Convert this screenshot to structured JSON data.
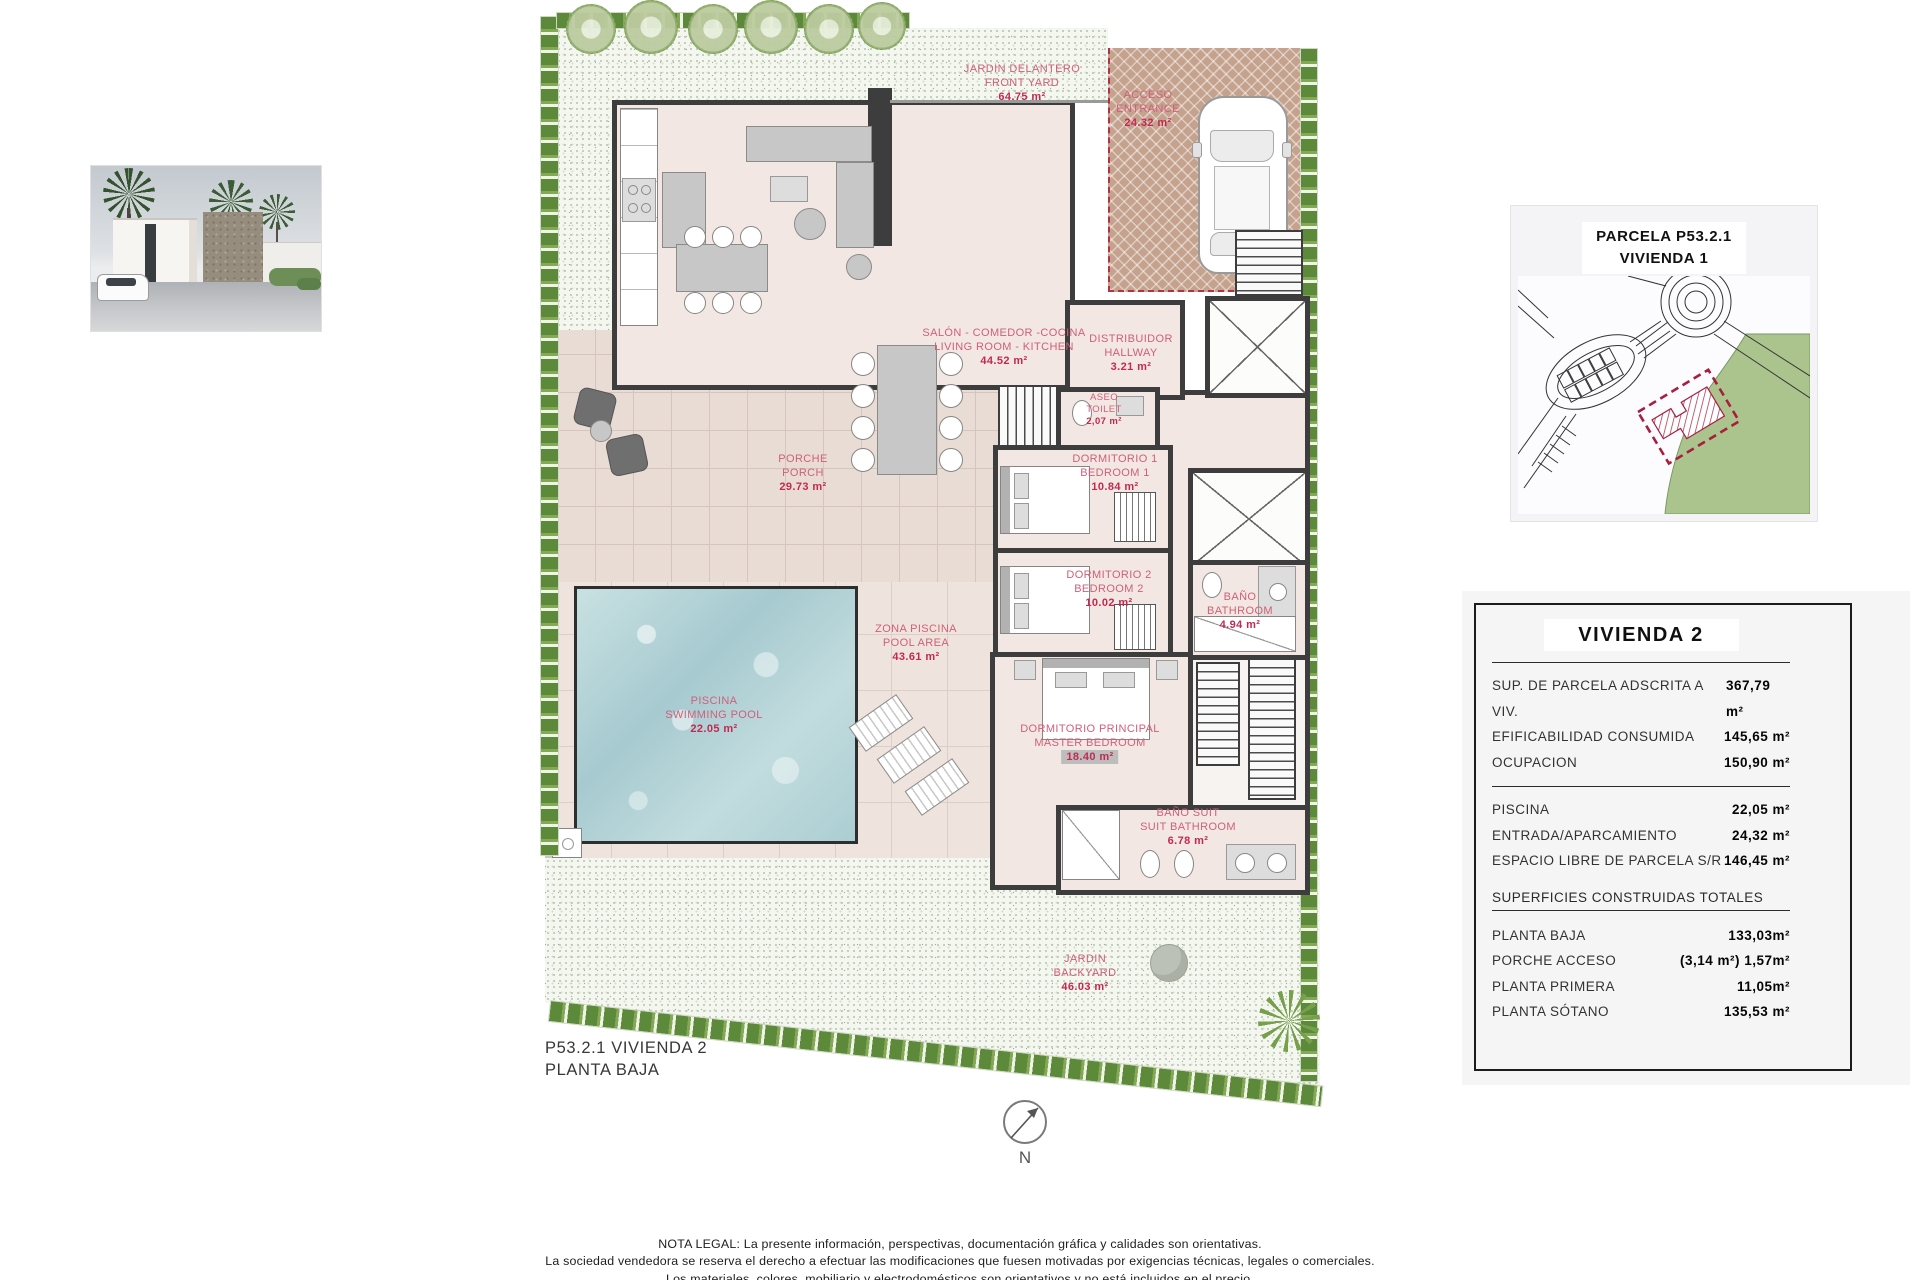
{
  "photo": {
    "name": "villa-exterior-render"
  },
  "site_map": {
    "title_line1": "PARCELA P53.2.1",
    "title_line2": "VIVIENDA 1"
  },
  "plan": {
    "rooms": [
      {
        "id": "front-yard",
        "es": "JARDIN DELANTERO",
        "en": "FRONT YARD",
        "area": "64.75 m²"
      },
      {
        "id": "entrance",
        "es": "ACCESO",
        "en": "ENTRANCE",
        "area": "24.32 m²"
      },
      {
        "id": "living",
        "es": "SALÓN - COMEDOR -COCINA",
        "en": "LIVING ROOM - KITCHEN",
        "area": "44.52 m²"
      },
      {
        "id": "hallway",
        "es": "DISTRIBUIDOR",
        "en": "HALLWAY",
        "area": "3.21 m²"
      },
      {
        "id": "toilet",
        "es": "ASEO",
        "en": "TOILET",
        "area": "2,07 m²"
      },
      {
        "id": "bedroom1",
        "es": "DORMITORIO 1",
        "en": "BEDROOM 1",
        "area": "10.84 m²"
      },
      {
        "id": "bedroom2",
        "es": "DORMITORIO 2",
        "en": "BEDROOM 2",
        "area": "10.02 m²"
      },
      {
        "id": "bathroom",
        "es": "BAÑO",
        "en": "BATHROOM",
        "area": "4.94 m²"
      },
      {
        "id": "master-bedroom",
        "es": "DORMITORIO PRINCIPAL",
        "en": "MASTER BEDROOM",
        "area": "18.40 m²"
      },
      {
        "id": "suite-bathroom",
        "es": "BAÑO SUIT",
        "en": "SUIT BATHROOM",
        "area": "6.78 m²"
      },
      {
        "id": "porch",
        "es": "PORCHE",
        "en": "PORCH",
        "area": "29.73 m²"
      },
      {
        "id": "pool-area",
        "es": "ZONA PISCINA",
        "en": "POOL AREA",
        "area": "43.61 m²"
      },
      {
        "id": "pool",
        "es": "PISCINA",
        "en": "SWIMMING POOL",
        "area": "22.05 m²"
      },
      {
        "id": "backyard",
        "es": "JARDIN",
        "en": "BACKYARD",
        "area": "46.03 m²"
      }
    ],
    "footer_line1": "P53.2.1 VIVIENDA 2",
    "footer_line2": "PLANTA BAJA",
    "compass_label": "N"
  },
  "summary_table": {
    "title": "VIVIENDA 2",
    "parcel_rows": [
      {
        "label": "SUP. DE PARCELA ADSCRITA A VIV.",
        "value": "367,79 m²"
      },
      {
        "label": "EFIFICABILIDAD CONSUMIDA",
        "value": "145,65 m²"
      },
      {
        "label": "OCUPACION",
        "value": "150,90 m²"
      }
    ],
    "exterior_rows": [
      {
        "label": "PISCINA",
        "value": "22,05 m²"
      },
      {
        "label": "ENTRADA/APARCAMIENTO",
        "value": "24,32 m²"
      },
      {
        "label": "ESPACIO LIBRE DE PARCELA S/R",
        "value": "146,45 m²"
      }
    ],
    "built_header": "SUPERFICIES CONSTRUIDAS TOTALES",
    "built_rows": [
      {
        "label": "PLANTA BAJA",
        "value": "133,03m²"
      },
      {
        "label": "PORCHE ACCESO",
        "value": "(3,14 m²) 1,57m²"
      },
      {
        "label": "PLANTA PRIMERA",
        "value": "11,05m²"
      },
      {
        "label": "PLANTA SÓTANO",
        "value": "135,53 m²"
      }
    ]
  },
  "legal": {
    "line1": "NOTA LEGAL: La presente información, perspectivas, documentación gráfica y calidades son orientativas.",
    "line2": "La sociedad vendedora se reserva el derecho a efectuar las modificaciones que fuesen motivadas por exigencias técnicas, legales o comerciales.",
    "line3": "Los materiales, colores, mobiliario y electrodomésticos son orientativos y no está incluidos en el precio."
  },
  "colors": {
    "label_pink": "#cf6079",
    "area_red": "#c12a51",
    "parcel_red": "#a81e3e",
    "hedge_green": "#5d8a3a",
    "pool_blue": "#b7d4d8",
    "wall_dark": "#3d3d3d"
  }
}
